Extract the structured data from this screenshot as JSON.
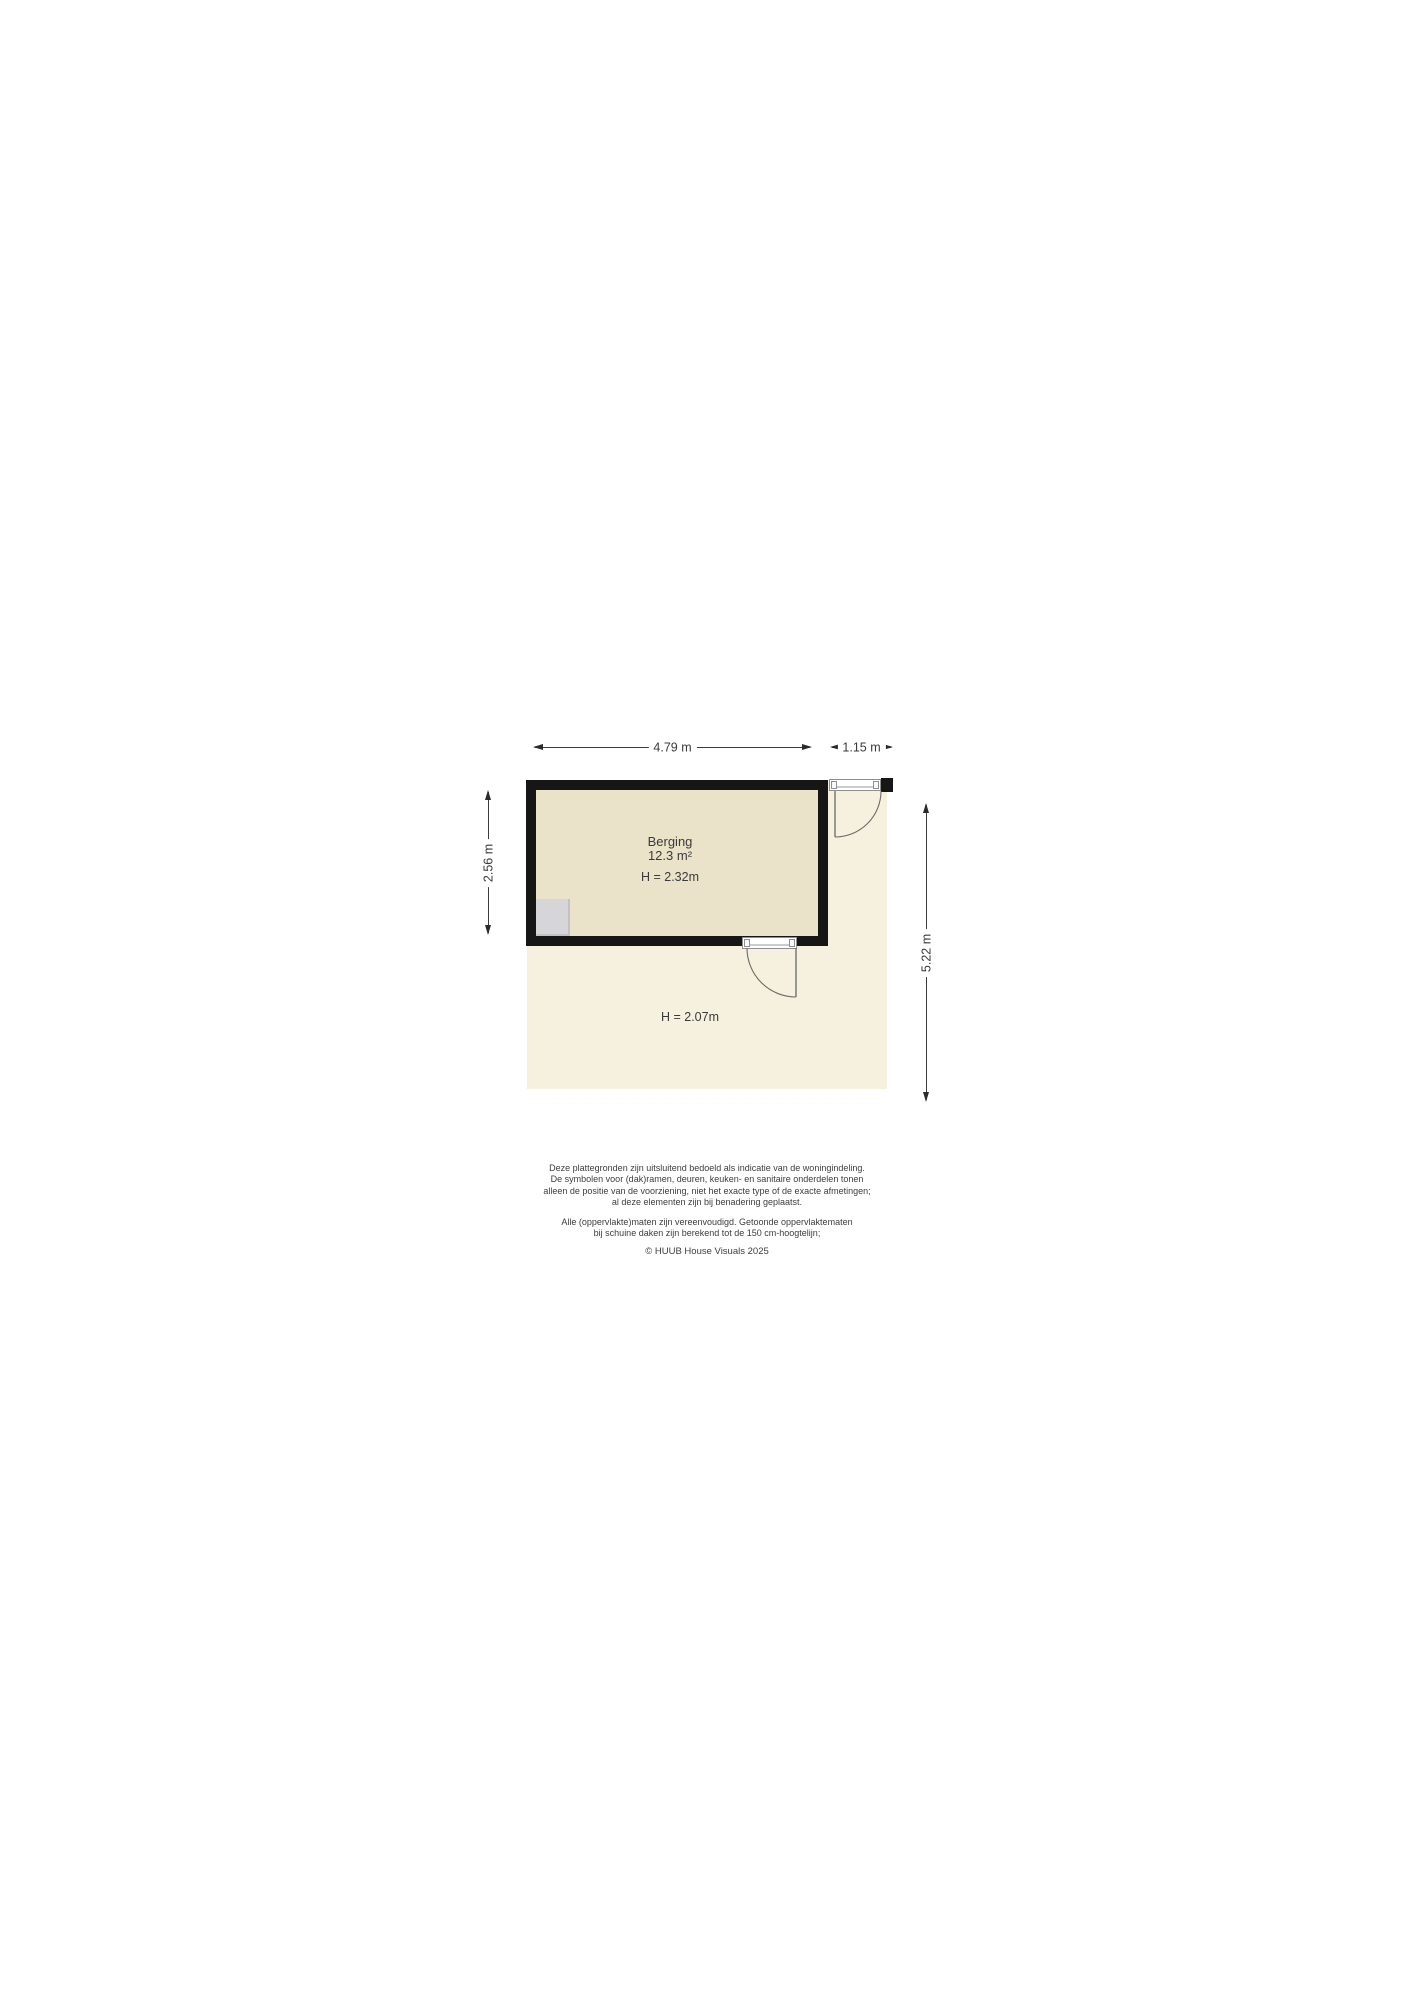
{
  "floorplan": {
    "room": {
      "name": "Berging",
      "area": "12.3 m²",
      "ceiling_height": "H = 2.32m"
    },
    "outdoor_height": "H = 2.07m",
    "dimensions": {
      "width_main": "4.79 m",
      "width_side": "1.15 m",
      "height_room": "2.56 m",
      "height_total": "5.22 m"
    },
    "colors": {
      "wall": "#161616",
      "room_floor": "#eae3c9",
      "outdoor_floor": "#f6f0de",
      "fixture": "#d6d6d8",
      "dimension_line": "#3c3c3c"
    }
  },
  "disclaimer": {
    "paragraph1": [
      "Deze plattegronden zijn uitsluitend bedoeld als indicatie van de woningindeling.",
      "De symbolen voor (dak)ramen, deuren, keuken- en sanitaire onderdelen tonen",
      "alleen de positie van de voorziening, niet het exacte type of de exacte afmetingen;",
      "al deze elementen zijn bij benadering geplaatst."
    ],
    "paragraph2": [
      "Alle (oppervlakte)maten zijn vereenvoudigd. Getoonde oppervlaktematen",
      "bij schuine daken zijn berekend tot de 150 cm-hoogtelijn;"
    ],
    "copyright": "© HUUB House Visuals 2025"
  }
}
